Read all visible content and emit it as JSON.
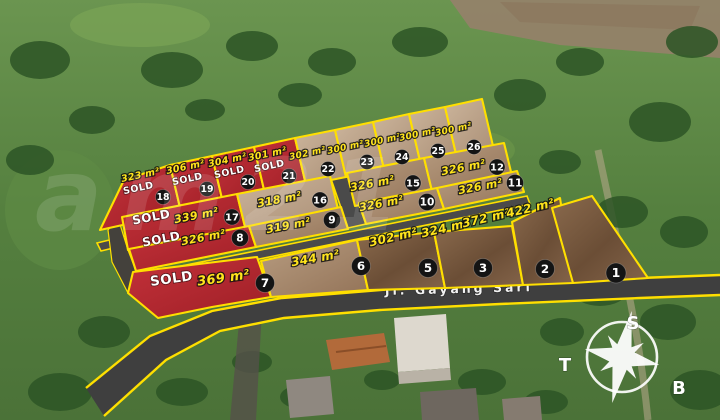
{
  "road": {
    "label": "Jl. Gayang Sari"
  },
  "watermark": "am21",
  "compass": {
    "top": "S",
    "left": "T",
    "right": "B"
  },
  "colors": {
    "line": "#ffdf00",
    "sold_fill_top": "#c3313a",
    "sold_fill_bottom": "#9e1f26",
    "badge_bg": "#141414",
    "area_text": "#ffe41c",
    "sold_text": "#ffffff"
  },
  "sold_label": "SOLD",
  "plots": [
    {
      "id": "18",
      "area": "323 m²",
      "sold": true,
      "fill": "red",
      "poly": "100,230 181,212 170,165 124,180",
      "badge": [
        163,
        197,
        7.5
      ],
      "label": [
        141,
        178,
        -12,
        9.5
      ],
      "sold_pos": [
        139,
        191,
        -12,
        9.5
      ]
    },
    {
      "id": "19",
      "area": "306 m²",
      "sold": true,
      "fill": "red",
      "poly": "181,212 223,203 212,156 170,165",
      "badge": [
        207,
        189,
        7.5
      ],
      "label": [
        186,
        170,
        -12,
        9.5
      ],
      "sold_pos": [
        188,
        182,
        -12,
        9.5
      ]
    },
    {
      "id": "20",
      "area": "304 m²",
      "sold": true,
      "fill": "red",
      "poly": "223,203 265,194 254,147 212,156",
      "badge": [
        248,
        182,
        7.5
      ],
      "label": [
        228,
        163,
        -12,
        9.5
      ],
      "sold_pos": [
        230,
        175,
        -12,
        9.5
      ]
    },
    {
      "id": "21",
      "area": "301 m²",
      "sold": true,
      "fill": "red",
      "poly": "265,194 306,185 295,138 254,147",
      "badge": [
        289,
        176,
        7.5
      ],
      "label": [
        268,
        157,
        -12,
        9.5
      ],
      "sold_pos": [
        270,
        169,
        -12,
        9.5
      ]
    },
    {
      "id": "22",
      "area": "302 m²",
      "sold": false,
      "fill": "d1",
      "poly": "306,185 346,177 335,130 295,138",
      "badge": [
        328,
        169,
        7.5
      ],
      "label": [
        308,
        156,
        -12,
        9
      ],
      "sold_pos": null
    },
    {
      "id": "23",
      "area": "300 m²",
      "sold": false,
      "fill": "d1",
      "poly": "346,177 384,169 373,122 335,130",
      "badge": [
        367,
        162,
        7.5
      ],
      "label": [
        346,
        150,
        -12,
        9
      ],
      "sold_pos": null
    },
    {
      "id": "24",
      "area": "300 m²",
      "sold": false,
      "fill": "d1",
      "poly": "384,169 420,161 409,114 373,122",
      "badge": [
        402,
        157,
        7.5
      ],
      "label": [
        383,
        143,
        -12,
        9
      ],
      "sold_pos": null
    },
    {
      "id": "25",
      "area": "300 m²",
      "sold": false,
      "fill": "d1",
      "poly": "420,161 456,154 445,107 409,114",
      "badge": [
        438,
        151,
        7.5
      ],
      "label": [
        418,
        137,
        -12,
        9
      ],
      "sold_pos": null
    },
    {
      "id": "26",
      "area": "300 m²",
      "sold": false,
      "fill": "d1",
      "poly": "456,154 493,146 482,99 445,107",
      "badge": [
        474,
        147,
        7.5
      ],
      "label": [
        454,
        132,
        -12,
        9
      ],
      "sold_pos": null
    },
    {
      "id": "17",
      "area": "339 m²",
      "sold": true,
      "fill": "red",
      "poly": "128,250 245,227 237,194 122,217",
      "badge": [
        232,
        217,
        8
      ],
      "label": [
        197,
        219,
        -11,
        11
      ],
      "sold_pos": [
        152,
        221,
        -11,
        12
      ]
    },
    {
      "id": "16",
      "area": "318 m²",
      "sold": false,
      "fill": "d1",
      "poly": "245,227 338,209 330,176 237,194",
      "badge": [
        320,
        200,
        8
      ],
      "label": [
        280,
        203,
        -11,
        11
      ],
      "sold_pos": null
    },
    {
      "id": "15",
      "area": "326 m²",
      "sold": false,
      "fill": "d2",
      "poly": "355,206 432,191 424,158 347,173",
      "badge": [
        413,
        183,
        8
      ],
      "label": [
        373,
        187,
        -11,
        11
      ],
      "sold_pos": null
    },
    {
      "id": "12",
      "area": "326 m²",
      "sold": false,
      "fill": "d2",
      "poly": "432,191 512,176 504,143 424,158",
      "badge": [
        497,
        167,
        8
      ],
      "label": [
        464,
        171,
        -11,
        11
      ],
      "sold_pos": null
    },
    {
      "id": "8",
      "area": "326 m²",
      "sold": true,
      "fill": "red",
      "poly": "136,271 256,247 249,226 129,249",
      "badge": [
        240,
        238,
        8.5
      ],
      "label": [
        204,
        241,
        -11,
        11
      ],
      "sold_pos": [
        162,
        243,
        -11,
        12
      ]
    },
    {
      "id": "9",
      "area": "319 m²",
      "sold": false,
      "fill": "d2",
      "poly": "256,247 348,229 341,207 249,226",
      "badge": [
        332,
        220,
        8.5
      ],
      "label": [
        289,
        229,
        -11,
        11
      ],
      "sold_pos": null
    },
    {
      "id": "10",
      "area": "326 m²",
      "sold": false,
      "fill": "d2",
      "poly": "366,224 444,209 437,188 359,203",
      "badge": [
        427,
        202,
        8.5
      ],
      "label": [
        382,
        207,
        -11,
        11
      ],
      "sold_pos": null
    },
    {
      "id": "11",
      "area": "326 m²",
      "sold": false,
      "fill": "d2",
      "poly": "444,209 524,192 517,171 437,188",
      "badge": [
        515,
        183,
        8.5
      ],
      "label": [
        481,
        190,
        -11,
        11
      ],
      "sold_pos": null
    },
    {
      "id": "7",
      "area": "369 m²",
      "sold": true,
      "fill": "red",
      "poly": "133,272 257,257 271,297 212,307 158,318 128,293",
      "badge": [
        265,
        283,
        9.5
      ],
      "label": [
        224,
        282,
        -8,
        13
      ],
      "sold_pos": [
        172,
        283,
        -8,
        13.5
      ]
    },
    {
      "id": "6",
      "area": "344 m²",
      "sold": false,
      "fill": "d2",
      "poly": "271,297 368,290 357,240 261,261",
      "badge": [
        361,
        266,
        9.5
      ],
      "label": [
        316,
        262,
        -10,
        12
      ],
      "sold_pos": null
    },
    {
      "id": "5",
      "area": "302 m²",
      "sold": false,
      "fill": "d3",
      "poly": "368,290 445,288 434,232 357,240",
      "badge": [
        428,
        268,
        9.5
      ],
      "label": [
        394,
        241,
        -13,
        12
      ],
      "sold_pos": null
    },
    {
      "id": "3",
      "area": "324 m²",
      "sold": false,
      "fill": "d3",
      "poly": "445,288 523,285 512,226 434,232",
      "badge": [
        483,
        268,
        9.5
      ],
      "label": [
        446,
        232,
        -13,
        12
      ],
      "sold_pos": null
    },
    {
      "id": "2",
      "area": "372 m²",
      "sold": false,
      "fill": "d3",
      "poly": "523,285 573,283 560,198 512,222",
      "badge": [
        545,
        269,
        9.5
      ],
      "label": [
        487,
        222,
        -13,
        12
      ],
      "sold_pos": null
    },
    {
      "id": "1",
      "area": "422 m²",
      "sold": false,
      "fill": "d3",
      "poly": "573,283 648,278 592,196 552,208",
      "badge": [
        616,
        273,
        10
      ],
      "label": [
        531,
        212,
        -13,
        12
      ],
      "sold_pos": null
    }
  ]
}
